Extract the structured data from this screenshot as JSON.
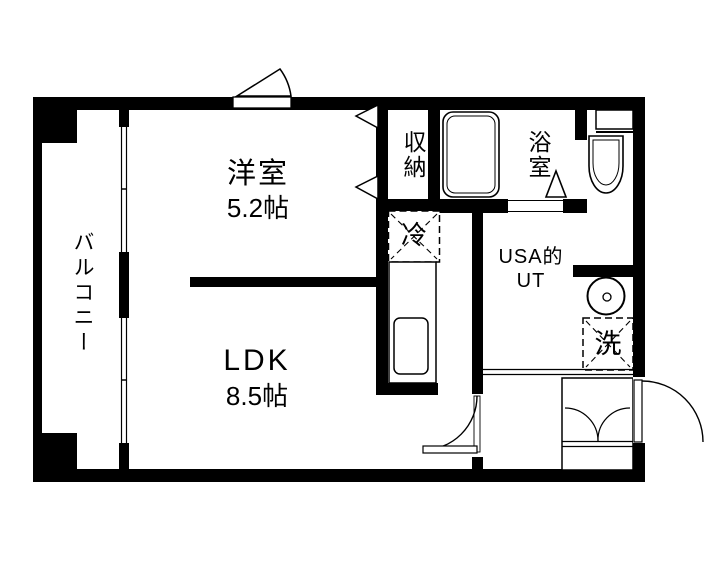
{
  "title": "apartment-floor-plan",
  "rooms": {
    "western_room": {
      "name": "洋室",
      "size": "5.2帖"
    },
    "ldk": {
      "name": "LDK",
      "size": "8.5帖"
    },
    "balcony": {
      "name": "バルコニー"
    },
    "storage": {
      "name": "収納"
    },
    "bathroom": {
      "name": "浴室"
    },
    "utility": {
      "line1": "USA的",
      "line2": "UT"
    }
  },
  "fixtures": {
    "refrigerator": {
      "label": "冷"
    },
    "washer": {
      "label": "洗"
    },
    "bathtub": {
      "icon": "bathtub-icon"
    },
    "toilet": {
      "icon": "toilet-icon"
    },
    "washbasin": {
      "icon": "washbasin-icon"
    },
    "kitchen_sink": {
      "icon": "kitchen-sink-icon"
    }
  },
  "colors": {
    "wall": "#000000",
    "floor": "#ffffff"
  }
}
